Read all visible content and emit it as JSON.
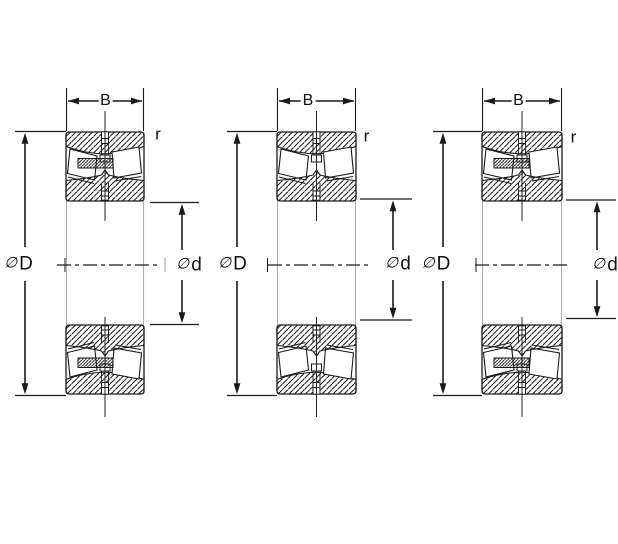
{
  "figure": {
    "kind": "bearing cross-section dimension drawing",
    "background_color": "#ffffff",
    "line_color": "#1a1a1a",
    "secondary_line_color": "#b0b0b0",
    "text_color": "#111111"
  },
  "bearings": [
    {
      "name": "bearing-left",
      "labels": {
        "width": "B",
        "corner_radius": "r",
        "diameter_symbol": "∅",
        "outer_diameter_letter": "D",
        "bore_diameter_letter": "d"
      },
      "features": {
        "center_guide_lip": true
      }
    },
    {
      "name": "bearing-middle",
      "labels": {
        "width": "B",
        "corner_radius": "r",
        "diameter_symbol": "∅",
        "outer_diameter_letter": "D",
        "bore_diameter_letter": "d"
      },
      "features": {
        "center_guide_lip": false
      }
    },
    {
      "name": "bearing-right",
      "labels": {
        "width": "B",
        "corner_radius": "r",
        "diameter_symbol": "∅",
        "outer_diameter_letter": "D",
        "bore_diameter_letter": "d"
      },
      "features": {
        "center_guide_lip": true
      }
    }
  ]
}
